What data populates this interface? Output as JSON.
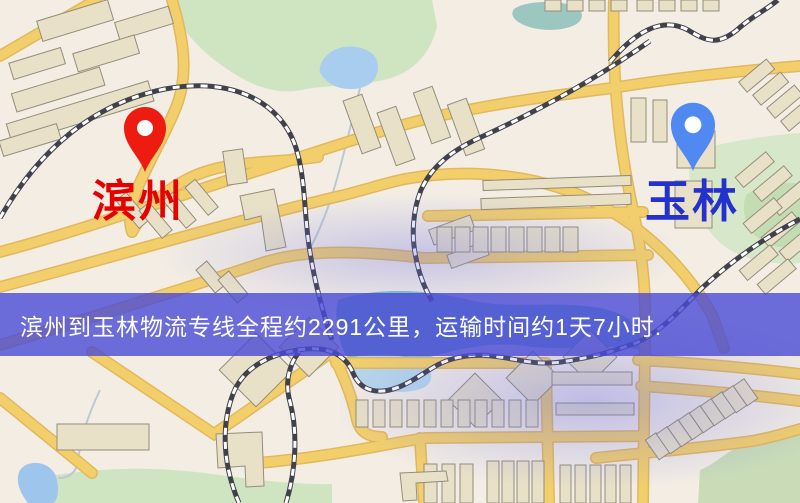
{
  "map": {
    "canvas": {
      "width": 800,
      "height": 503
    },
    "origin": {
      "name": "滨州",
      "label_color": "#e60000",
      "pin_color": "#ed1b10"
    },
    "destination": {
      "name": "玉林",
      "label_color": "#2531cc",
      "pin_color": "#5089f2"
    },
    "banner": {
      "text": "滨州到玉林物流专线全程约2291公里，运输时间约1天7小时.",
      "background_color": "#4a4cd6",
      "text_color": "#ffffff",
      "route": {
        "from": "滨州",
        "to": "玉林",
        "distance_km": "2291",
        "duration": "1天7小时"
      }
    },
    "palette": {
      "background": "#f3ede4",
      "road": "#f3cf6b",
      "road_casing": "#e2b85d",
      "park": "#cfe4c1",
      "water": "#a9cdee",
      "river": "#83bfc6",
      "railway_dark": "#41414b",
      "building_fill": "#e9e1c7",
      "building_stroke": "#938d7b",
      "overlay_tint": "#6e73e6"
    }
  }
}
